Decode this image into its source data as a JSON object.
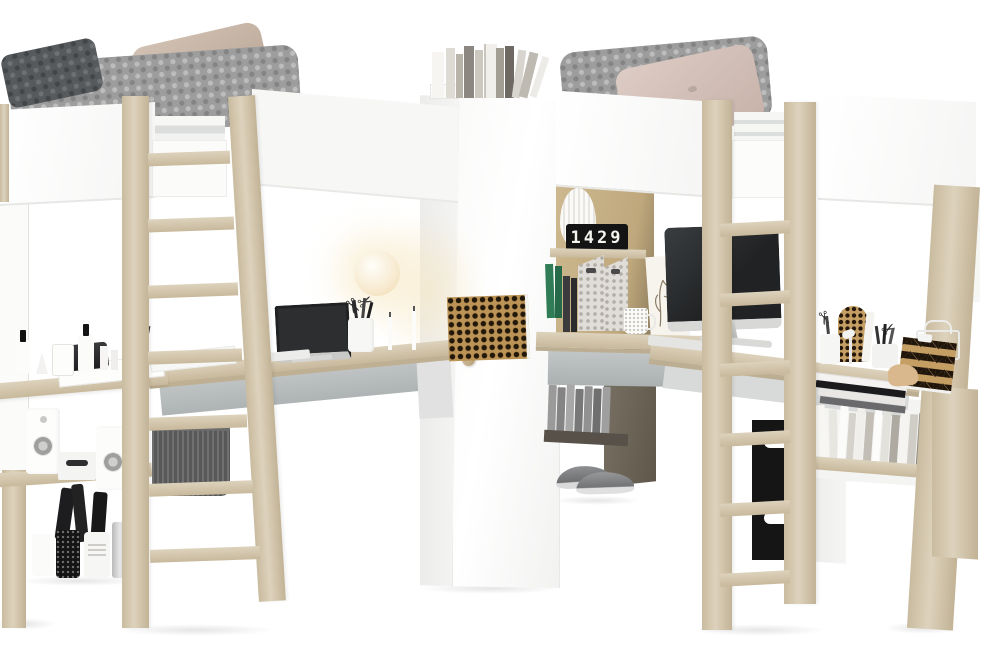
{
  "scene": {
    "type": "furniture-product-photo",
    "subject": "Corner high-sleeper loft bed set: two loft beds with white rails and light-oak posts, corner wardrobe, desks, open shelving and ladders on a white studio background",
    "background": "#ffffff"
  },
  "clock": {
    "digits": "1429"
  },
  "palette": {
    "wood_light": "#ddd2bc",
    "wood_mid": "#c2b396",
    "panel_white": "#fbfbfa",
    "support_gray": "#b4b9ba",
    "blanket_gray": "#9d9d9d",
    "pillow_dark_gray": "#565a5c",
    "pillow_beige": "#c8b6a6",
    "pillow_blush": "#d5c2ba",
    "basket_dark_gray": "#585858",
    "basket_black": "#151515",
    "clock_black": "#141414",
    "clock_digits_white": "#f4f4ef",
    "book_green": "#2f7c57",
    "pattern_tan": "#c49e63",
    "pattern_black": "#20150b",
    "screen_dark": "#2c2e2f"
  },
  "inventory": {
    "left_bed": [
      "gray knitted blanket",
      "dark gray knitted pillow",
      "beige cushion",
      "white safety rails",
      "light oak posts and ladder"
    ],
    "right_bed": [
      "gray knitted blanket",
      "blush cushion",
      "white safety rails",
      "light oak posts and ladder"
    ],
    "wardrobe": [
      "white corner wardrobe",
      "vertical wooden door handle",
      "row of books on top"
    ],
    "left_desk": [
      "black monitor",
      "white papers",
      "black media device",
      "pen cup with scissors and pens",
      "glowing sphere lamp",
      "white candlesticks",
      "checkered pinboard"
    ],
    "right_desk": [
      "all-in-one computer with keyboard",
      "botanical art print",
      "speckled mug",
      "black flip clock",
      "white ribbed vase",
      "two patterned magazine files",
      "green and dark books",
      "pen cups with scissors",
      "honeycomb arch bookend",
      "chevron clipboard",
      "white wire basket",
      "wooden animal figurine",
      "stack of magazines"
    ],
    "left_shelf_unit": [
      "cosmetic bottles and tubes",
      "reed diffuser",
      "two white speakers",
      "white stereo unit",
      "gray fabric basket",
      "storage jars",
      "black bottles"
    ],
    "right_shelf_unit": [
      "row of white books",
      "gray books",
      "gray sneakers",
      "black storage basket"
    ]
  }
}
